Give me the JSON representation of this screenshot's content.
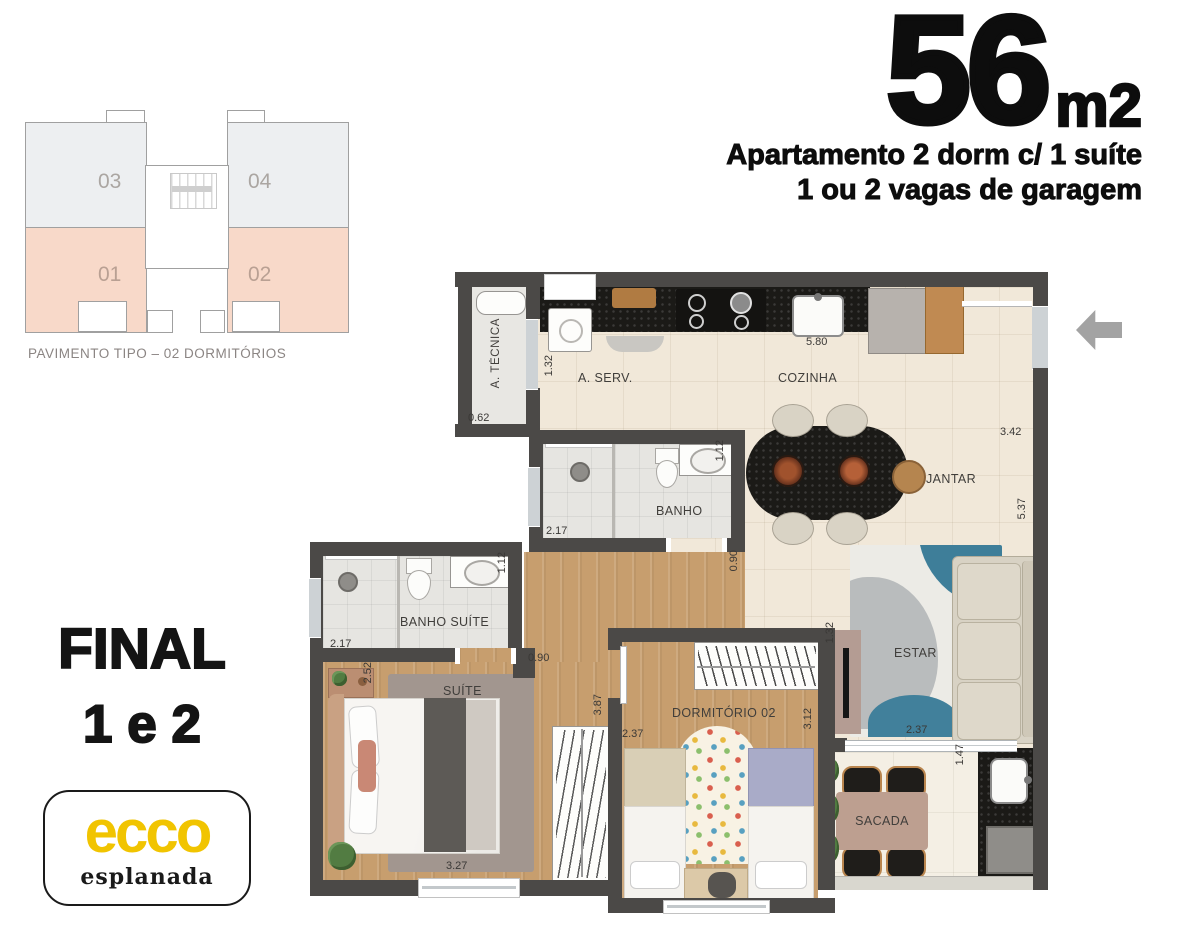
{
  "header": {
    "area": "56",
    "unit": "m2",
    "subtitle1": "Apartamento 2 dorm c/ 1 suíte",
    "subtitle2": "1 ou 2 vagas de garagem"
  },
  "key_plan": {
    "caption": "PAVIMENTO TIPO – 02 DORMITÓRIOS",
    "units": {
      "u03": "03",
      "u04": "04",
      "u01": "01",
      "u02": "02"
    }
  },
  "stack": {
    "final_line1": "FINAL",
    "final_line2": "1 e 2"
  },
  "logo": {
    "brand": "ecco",
    "subbrand": "esplanada"
  },
  "plan": {
    "rooms": {
      "atecnica": "A. TÉCNICA",
      "aserv": "A. SERV.",
      "cozinha": "COZINHA",
      "jantar": "JANTAR",
      "banho": "BANHO",
      "banho_suite": "BANHO SUÍTE",
      "suite": "SUÍTE",
      "dormitorio02": "DORMITÓRIO 02",
      "estar": "ESTAR",
      "sacada": "SACADA"
    },
    "measurements": {
      "atecnica_w": "0.62",
      "aserv_w": "1.32",
      "cozinha_len": "5.80",
      "cozinha_w": "3.42",
      "living_len": "5.37",
      "banho_len": "2.17",
      "banho_w": "1.12",
      "banho_pass": "0.90",
      "bsuite_len": "2.17",
      "bsuite_w": "1.12",
      "hall_w": "0.90",
      "hall_len": "3.87",
      "suite_w": "2.52",
      "suite_len": "3.27",
      "dorm2_w": "2.37",
      "dorm2_len": "3.12",
      "tv_wall": "1.32",
      "estar_w": "2.37",
      "sacada_w": "1.47"
    }
  },
  "colors": {
    "wall": "#4b4947",
    "floor_tile": "#f1e8d9",
    "floor_wood": "#c79e6e",
    "counter_black": "#1b1a17",
    "unit_highlight": "#f8d9c9",
    "unit_normal": "#edeff1",
    "brand_yellow": "#f1c400",
    "arrow_gray": "#a3a3a3"
  }
}
